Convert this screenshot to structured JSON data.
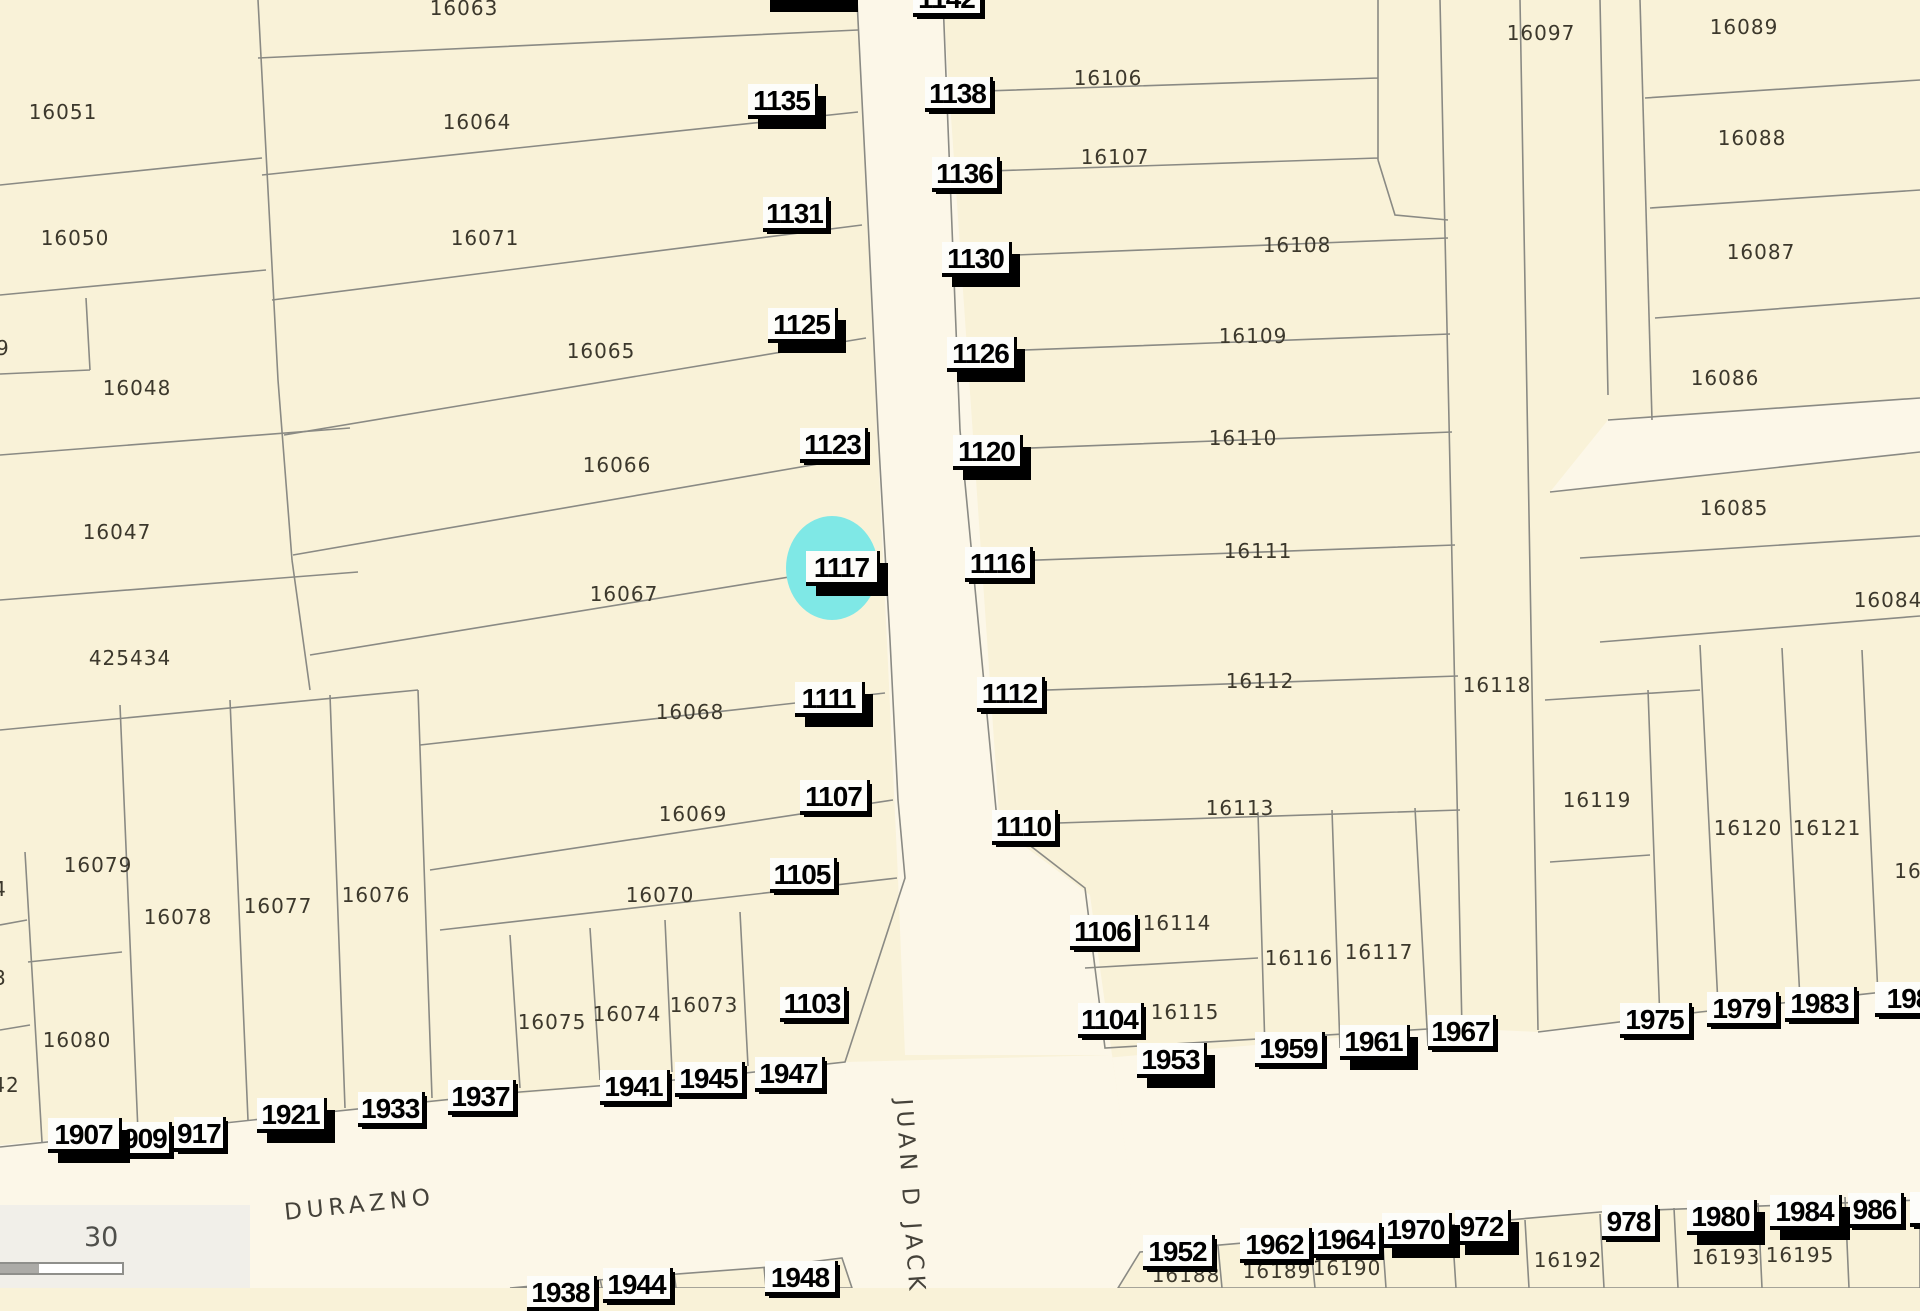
{
  "map": {
    "background_color": "#F9F2D8",
    "street_color": "#FCF7E8",
    "parcel_line_color": "#8A8A84",
    "parcel_number_color": "#3C382C",
    "address_label_bg": "#FDFDFA",
    "address_label_text": "#000000"
  },
  "streets": {
    "horizontal_name": "DURAZNO",
    "diagonal_name": "JUAN D JACK"
  },
  "scale_bar": {
    "value": "30"
  },
  "highlight": {
    "address": "1117",
    "color": "#7FE8E6",
    "x": 786,
    "y": 516,
    "w": 92,
    "h": 104
  },
  "parcel_labels": [
    {
      "id": "16063",
      "x": 464,
      "y": 8
    },
    {
      "id": "16051",
      "x": 63,
      "y": 112
    },
    {
      "id": "16064",
      "x": 477,
      "y": 122
    },
    {
      "id": "16050",
      "x": 75,
      "y": 238
    },
    {
      "id": "16071",
      "x": 485,
      "y": 238
    },
    {
      "id": "49",
      "x": -4,
      "y": 348
    },
    {
      "id": "16048",
      "x": 137,
      "y": 388
    },
    {
      "id": "16065",
      "x": 601,
      "y": 351
    },
    {
      "id": "16066",
      "x": 617,
      "y": 465
    },
    {
      "id": "16067",
      "x": 624,
      "y": 594
    },
    {
      "id": "16047",
      "x": 117,
      "y": 532
    },
    {
      "id": "425434",
      "x": 130,
      "y": 658
    },
    {
      "id": "16068",
      "x": 690,
      "y": 712
    },
    {
      "id": "16069",
      "x": 693,
      "y": 814
    },
    {
      "id": "16070",
      "x": 660,
      "y": 895
    },
    {
      "id": "16079",
      "x": 98,
      "y": 865
    },
    {
      "id": "16078",
      "x": 178,
      "y": 917
    },
    {
      "id": "16077",
      "x": 278,
      "y": 906
    },
    {
      "id": "16076",
      "x": 376,
      "y": 895
    },
    {
      "id": "16080",
      "x": 77,
      "y": 1040
    },
    {
      "id": "16075",
      "x": 552,
      "y": 1022
    },
    {
      "id": "16074",
      "x": 627,
      "y": 1014
    },
    {
      "id": "16073",
      "x": 704,
      "y": 1005
    },
    {
      "id": "4",
      "x": 0,
      "y": 889
    },
    {
      "id": "3",
      "x": 0,
      "y": 978
    },
    {
      "id": "42",
      "x": 6,
      "y": 1085
    },
    {
      "id": "16106",
      "x": 1108,
      "y": 78
    },
    {
      "id": "16107",
      "x": 1115,
      "y": 157
    },
    {
      "id": "16108",
      "x": 1297,
      "y": 245
    },
    {
      "id": "16109",
      "x": 1253,
      "y": 336
    },
    {
      "id": "16110",
      "x": 1243,
      "y": 438
    },
    {
      "id": "16111",
      "x": 1258,
      "y": 551
    },
    {
      "id": "16112",
      "x": 1260,
      "y": 681
    },
    {
      "id": "16113",
      "x": 1240,
      "y": 808
    },
    {
      "id": "16114",
      "x": 1177,
      "y": 923
    },
    {
      "id": "16115",
      "x": 1185,
      "y": 1012
    },
    {
      "id": "16116",
      "x": 1299,
      "y": 958
    },
    {
      "id": "16117",
      "x": 1379,
      "y": 952
    },
    {
      "id": "16118",
      "x": 1497,
      "y": 685
    },
    {
      "id": "16119",
      "x": 1597,
      "y": 800
    },
    {
      "id": "16120",
      "x": 1748,
      "y": 828
    },
    {
      "id": "16121",
      "x": 1827,
      "y": 828
    },
    {
      "id": "16",
      "x": 1908,
      "y": 871
    },
    {
      "id": "16097",
      "x": 1541,
      "y": 33
    },
    {
      "id": "16089",
      "x": 1744,
      "y": 27
    },
    {
      "id": "16088",
      "x": 1752,
      "y": 138
    },
    {
      "id": "16087",
      "x": 1761,
      "y": 252
    },
    {
      "id": "16086",
      "x": 1725,
      "y": 378
    },
    {
      "id": "16085",
      "x": 1734,
      "y": 508
    },
    {
      "id": "16084",
      "x": 1888,
      "y": 600
    },
    {
      "id": "16188",
      "x": 1186,
      "y": 1275
    },
    {
      "id": "16189",
      "x": 1277,
      "y": 1271
    },
    {
      "id": "16190",
      "x": 1347,
      "y": 1268
    },
    {
      "id": "16192",
      "x": 1568,
      "y": 1260
    },
    {
      "id": "16193",
      "x": 1726,
      "y": 1257
    },
    {
      "id": "16195",
      "x": 1800,
      "y": 1255
    }
  ],
  "address_labels": [
    {
      "text": "1135",
      "x": 748,
      "y": 84,
      "w": 70,
      "shadow": "thick"
    },
    {
      "text": "1131",
      "x": 763,
      "y": 197,
      "w": 66,
      "shadow": "thin"
    },
    {
      "text": "1125",
      "x": 768,
      "y": 308,
      "w": 70,
      "shadow": "thick"
    },
    {
      "text": "1123",
      "x": 800,
      "y": 428,
      "w": 68,
      "shadow": "thin"
    },
    {
      "text": "1117",
      "x": 806,
      "y": 551,
      "w": 74,
      "shadow": "thick"
    },
    {
      "text": "1111",
      "x": 795,
      "y": 682,
      "w": 70,
      "shadow": "thick"
    },
    {
      "text": "1107",
      "x": 800,
      "y": 780,
      "w": 70,
      "shadow": "thin"
    },
    {
      "text": "1105",
      "x": 770,
      "y": 858,
      "w": 67,
      "shadow": "thin"
    },
    {
      "text": "1103",
      "x": 780,
      "y": 987,
      "w": 67,
      "shadow": "thin"
    },
    {
      "text": "1142",
      "x": 913,
      "y": -18,
      "w": 70,
      "shadow": "thin"
    },
    {
      "text": "1138",
      "x": 925,
      "y": 77,
      "w": 68,
      "shadow": "thin"
    },
    {
      "text": "1136",
      "x": 932,
      "y": 157,
      "w": 68,
      "shadow": "thin"
    },
    {
      "text": "1130",
      "x": 942,
      "y": 242,
      "w": 70,
      "shadow": "thick"
    },
    {
      "text": "1126",
      "x": 947,
      "y": 337,
      "w": 70,
      "shadow": "thick"
    },
    {
      "text": "1120",
      "x": 953,
      "y": 435,
      "w": 70,
      "shadow": "thick"
    },
    {
      "text": "1116",
      "x": 965,
      "y": 547,
      "w": 68,
      "shadow": "thin"
    },
    {
      "text": "1112",
      "x": 977,
      "y": 677,
      "w": 68,
      "shadow": "thin"
    },
    {
      "text": "1110",
      "x": 992,
      "y": 810,
      "w": 66,
      "shadow": "thin"
    },
    {
      "text": "1106",
      "x": 1070,
      "y": 915,
      "w": 68,
      "shadow": "thin"
    },
    {
      "text": "1104",
      "x": 1078,
      "y": 1003,
      "w": 66,
      "shadow": "thin"
    },
    {
      "text": "1907",
      "x": 48,
      "y": 1118,
      "w": 74,
      "shadow": "thick"
    },
    {
      "text": "909",
      "x": 120,
      "y": 1122,
      "w": 52,
      "shadow": "thin"
    },
    {
      "text": "917",
      "x": 174,
      "y": 1117,
      "w": 52,
      "shadow": "thin"
    },
    {
      "text": "1921",
      "x": 257,
      "y": 1098,
      "w": 70,
      "shadow": "thick"
    },
    {
      "text": "1933",
      "x": 358,
      "y": 1092,
      "w": 67,
      "shadow": "thin"
    },
    {
      "text": "1937",
      "x": 448,
      "y": 1080,
      "w": 68,
      "shadow": "thin"
    },
    {
      "text": "1941",
      "x": 600,
      "y": 1070,
      "w": 70,
      "shadow": "thin"
    },
    {
      "text": "1945",
      "x": 675,
      "y": 1062,
      "w": 70,
      "shadow": "thin"
    },
    {
      "text": "1947",
      "x": 755,
      "y": 1057,
      "w": 70,
      "shadow": "thin"
    },
    {
      "text": "1938",
      "x": 527,
      "y": 1276,
      "w": 70,
      "shadow": "thin"
    },
    {
      "text": "1944",
      "x": 603,
      "y": 1268,
      "w": 70,
      "shadow": "thin"
    },
    {
      "text": "1948",
      "x": 765,
      "y": 1261,
      "w": 73,
      "shadow": "thin"
    },
    {
      "text": "1953",
      "x": 1137,
      "y": 1043,
      "w": 70,
      "shadow": "thick"
    },
    {
      "text": "1959",
      "x": 1255,
      "y": 1032,
      "w": 70,
      "shadow": "thin"
    },
    {
      "text": "1961",
      "x": 1340,
      "y": 1025,
      "w": 70,
      "shadow": "thick"
    },
    {
      "text": "1967",
      "x": 1428,
      "y": 1015,
      "w": 68,
      "shadow": "thin"
    },
    {
      "text": "1975",
      "x": 1620,
      "y": 1003,
      "w": 72,
      "shadow": "thin"
    },
    {
      "text": "1979",
      "x": 1707,
      "y": 992,
      "w": 72,
      "shadow": "thin"
    },
    {
      "text": "1983",
      "x": 1785,
      "y": 987,
      "w": 72,
      "shadow": "thin"
    },
    {
      "text": "198",
      "x": 1875,
      "y": 982,
      "w": 70,
      "shadow": "thin"
    },
    {
      "text": "1952",
      "x": 1143,
      "y": 1235,
      "w": 72,
      "shadow": "thin"
    },
    {
      "text": "1962",
      "x": 1240,
      "y": 1228,
      "w": 72,
      "shadow": "thin"
    },
    {
      "text": "1964",
      "x": 1312,
      "y": 1223,
      "w": 70,
      "shadow": "thin"
    },
    {
      "text": "1970",
      "x": 1382,
      "y": 1213,
      "w": 70,
      "shadow": "thick"
    },
    {
      "text": "972",
      "x": 1455,
      "y": 1210,
      "w": 56,
      "shadow": "thick"
    },
    {
      "text": "978",
      "x": 1602,
      "y": 1205,
      "w": 56,
      "shadow": "thin"
    },
    {
      "text": "1980",
      "x": 1687,
      "y": 1200,
      "w": 70,
      "shadow": "thick"
    },
    {
      "text": "1984",
      "x": 1770,
      "y": 1195,
      "w": 72,
      "shadow": "thick"
    },
    {
      "text": "986",
      "x": 1848,
      "y": 1193,
      "w": 56,
      "shadow": "thin"
    },
    {
      "text": "19",
      "x": 1910,
      "y": 1192,
      "w": 50,
      "shadow": "thin"
    }
  ],
  "street_name_placement": {
    "durazno": {
      "x": 283,
      "y": 1200,
      "rotation": -6
    },
    "juan_d_jack": {
      "x": 916,
      "y": 1098,
      "rotation": 86
    }
  }
}
